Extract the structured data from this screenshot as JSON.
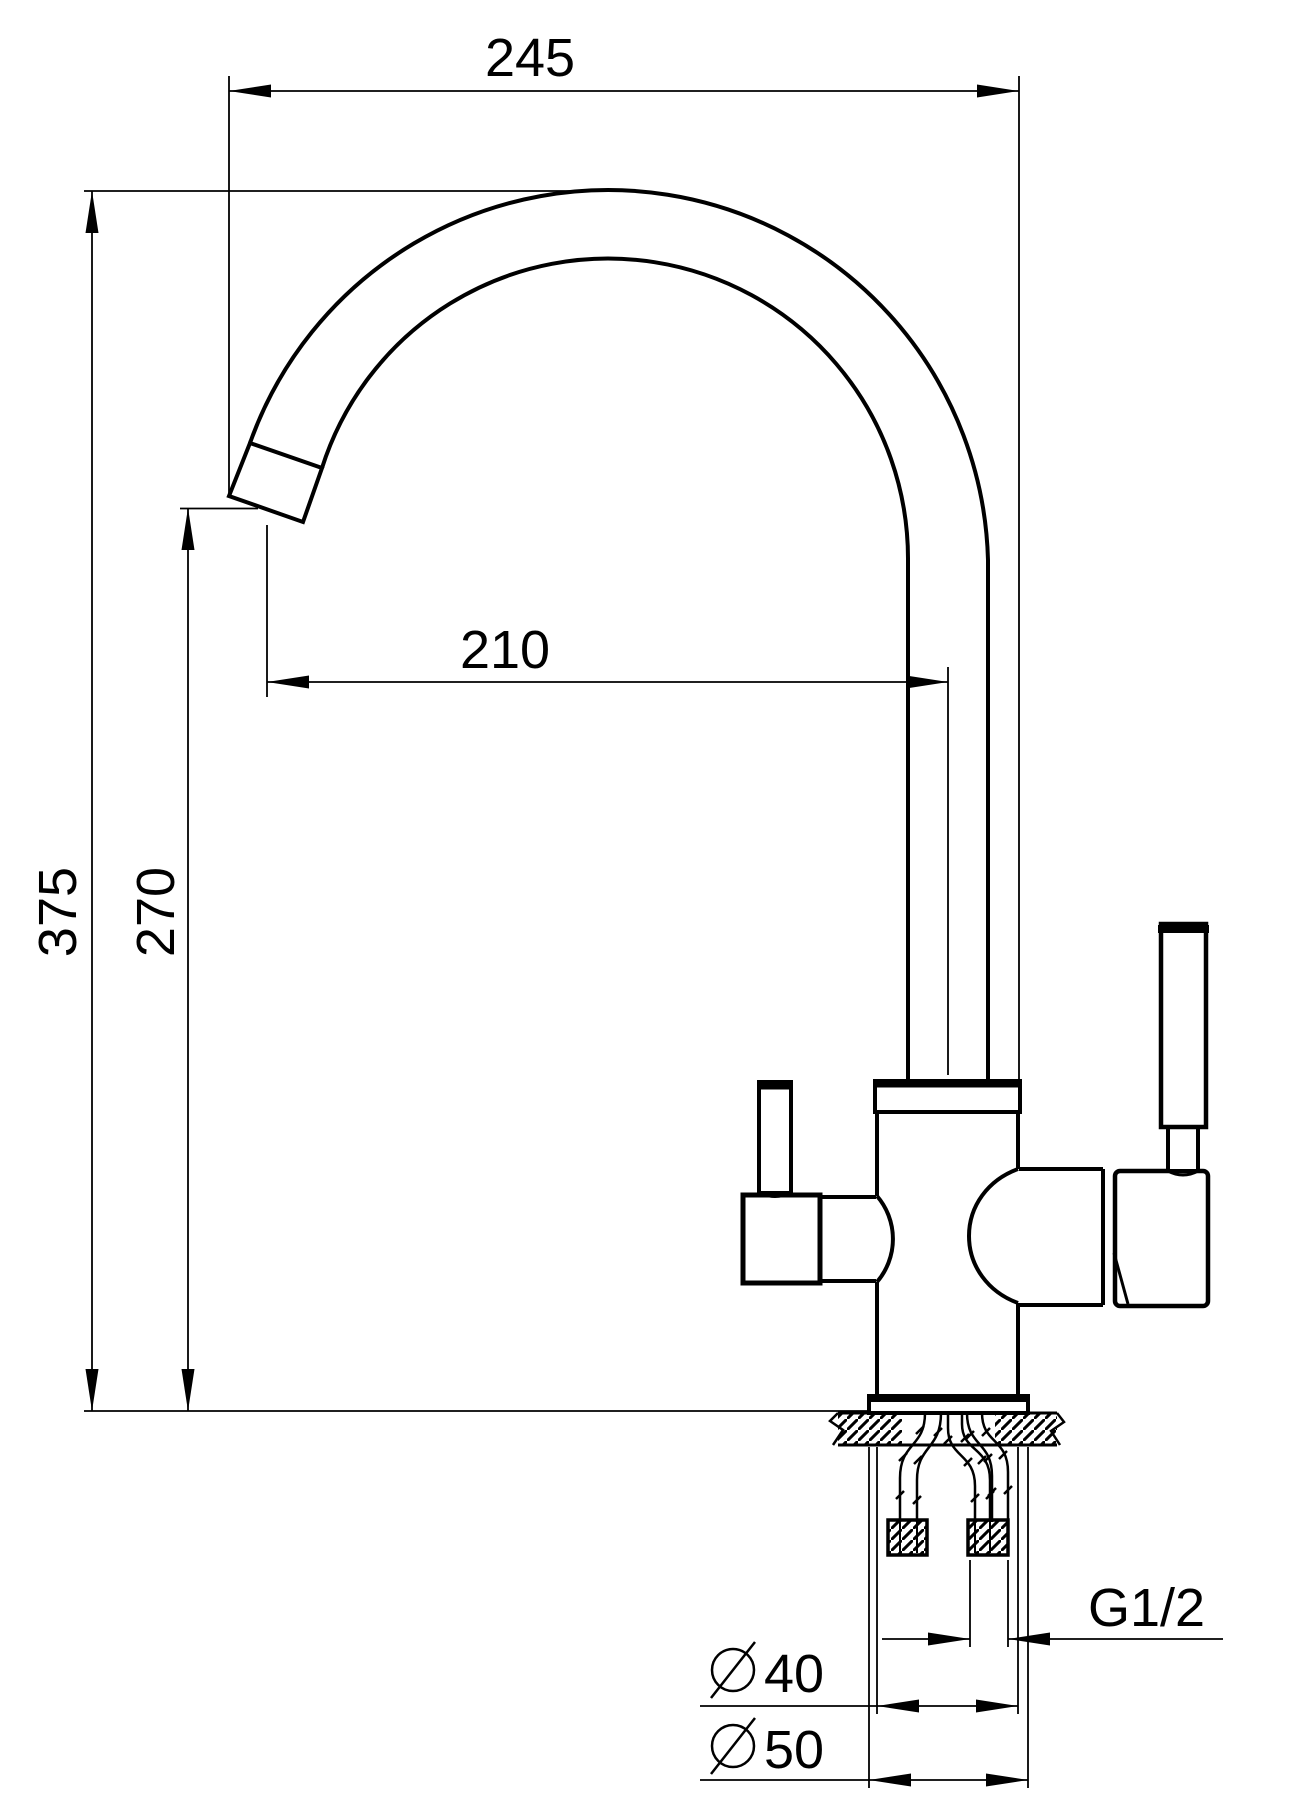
{
  "drawing": {
    "type": "technical-dimension-drawing",
    "subject": "kitchen-faucet-side-view",
    "labels": {
      "overall_width": "245",
      "spout_reach": "210",
      "overall_height": "375",
      "spout_outlet_height": "270",
      "thread_size": "G1/2",
      "body_diameter_value": "40",
      "base_diameter_value": "50"
    },
    "symbols": {
      "diameter": "slashed-circle"
    },
    "colors": {
      "line": "#000000",
      "background": "#ffffff"
    }
  }
}
